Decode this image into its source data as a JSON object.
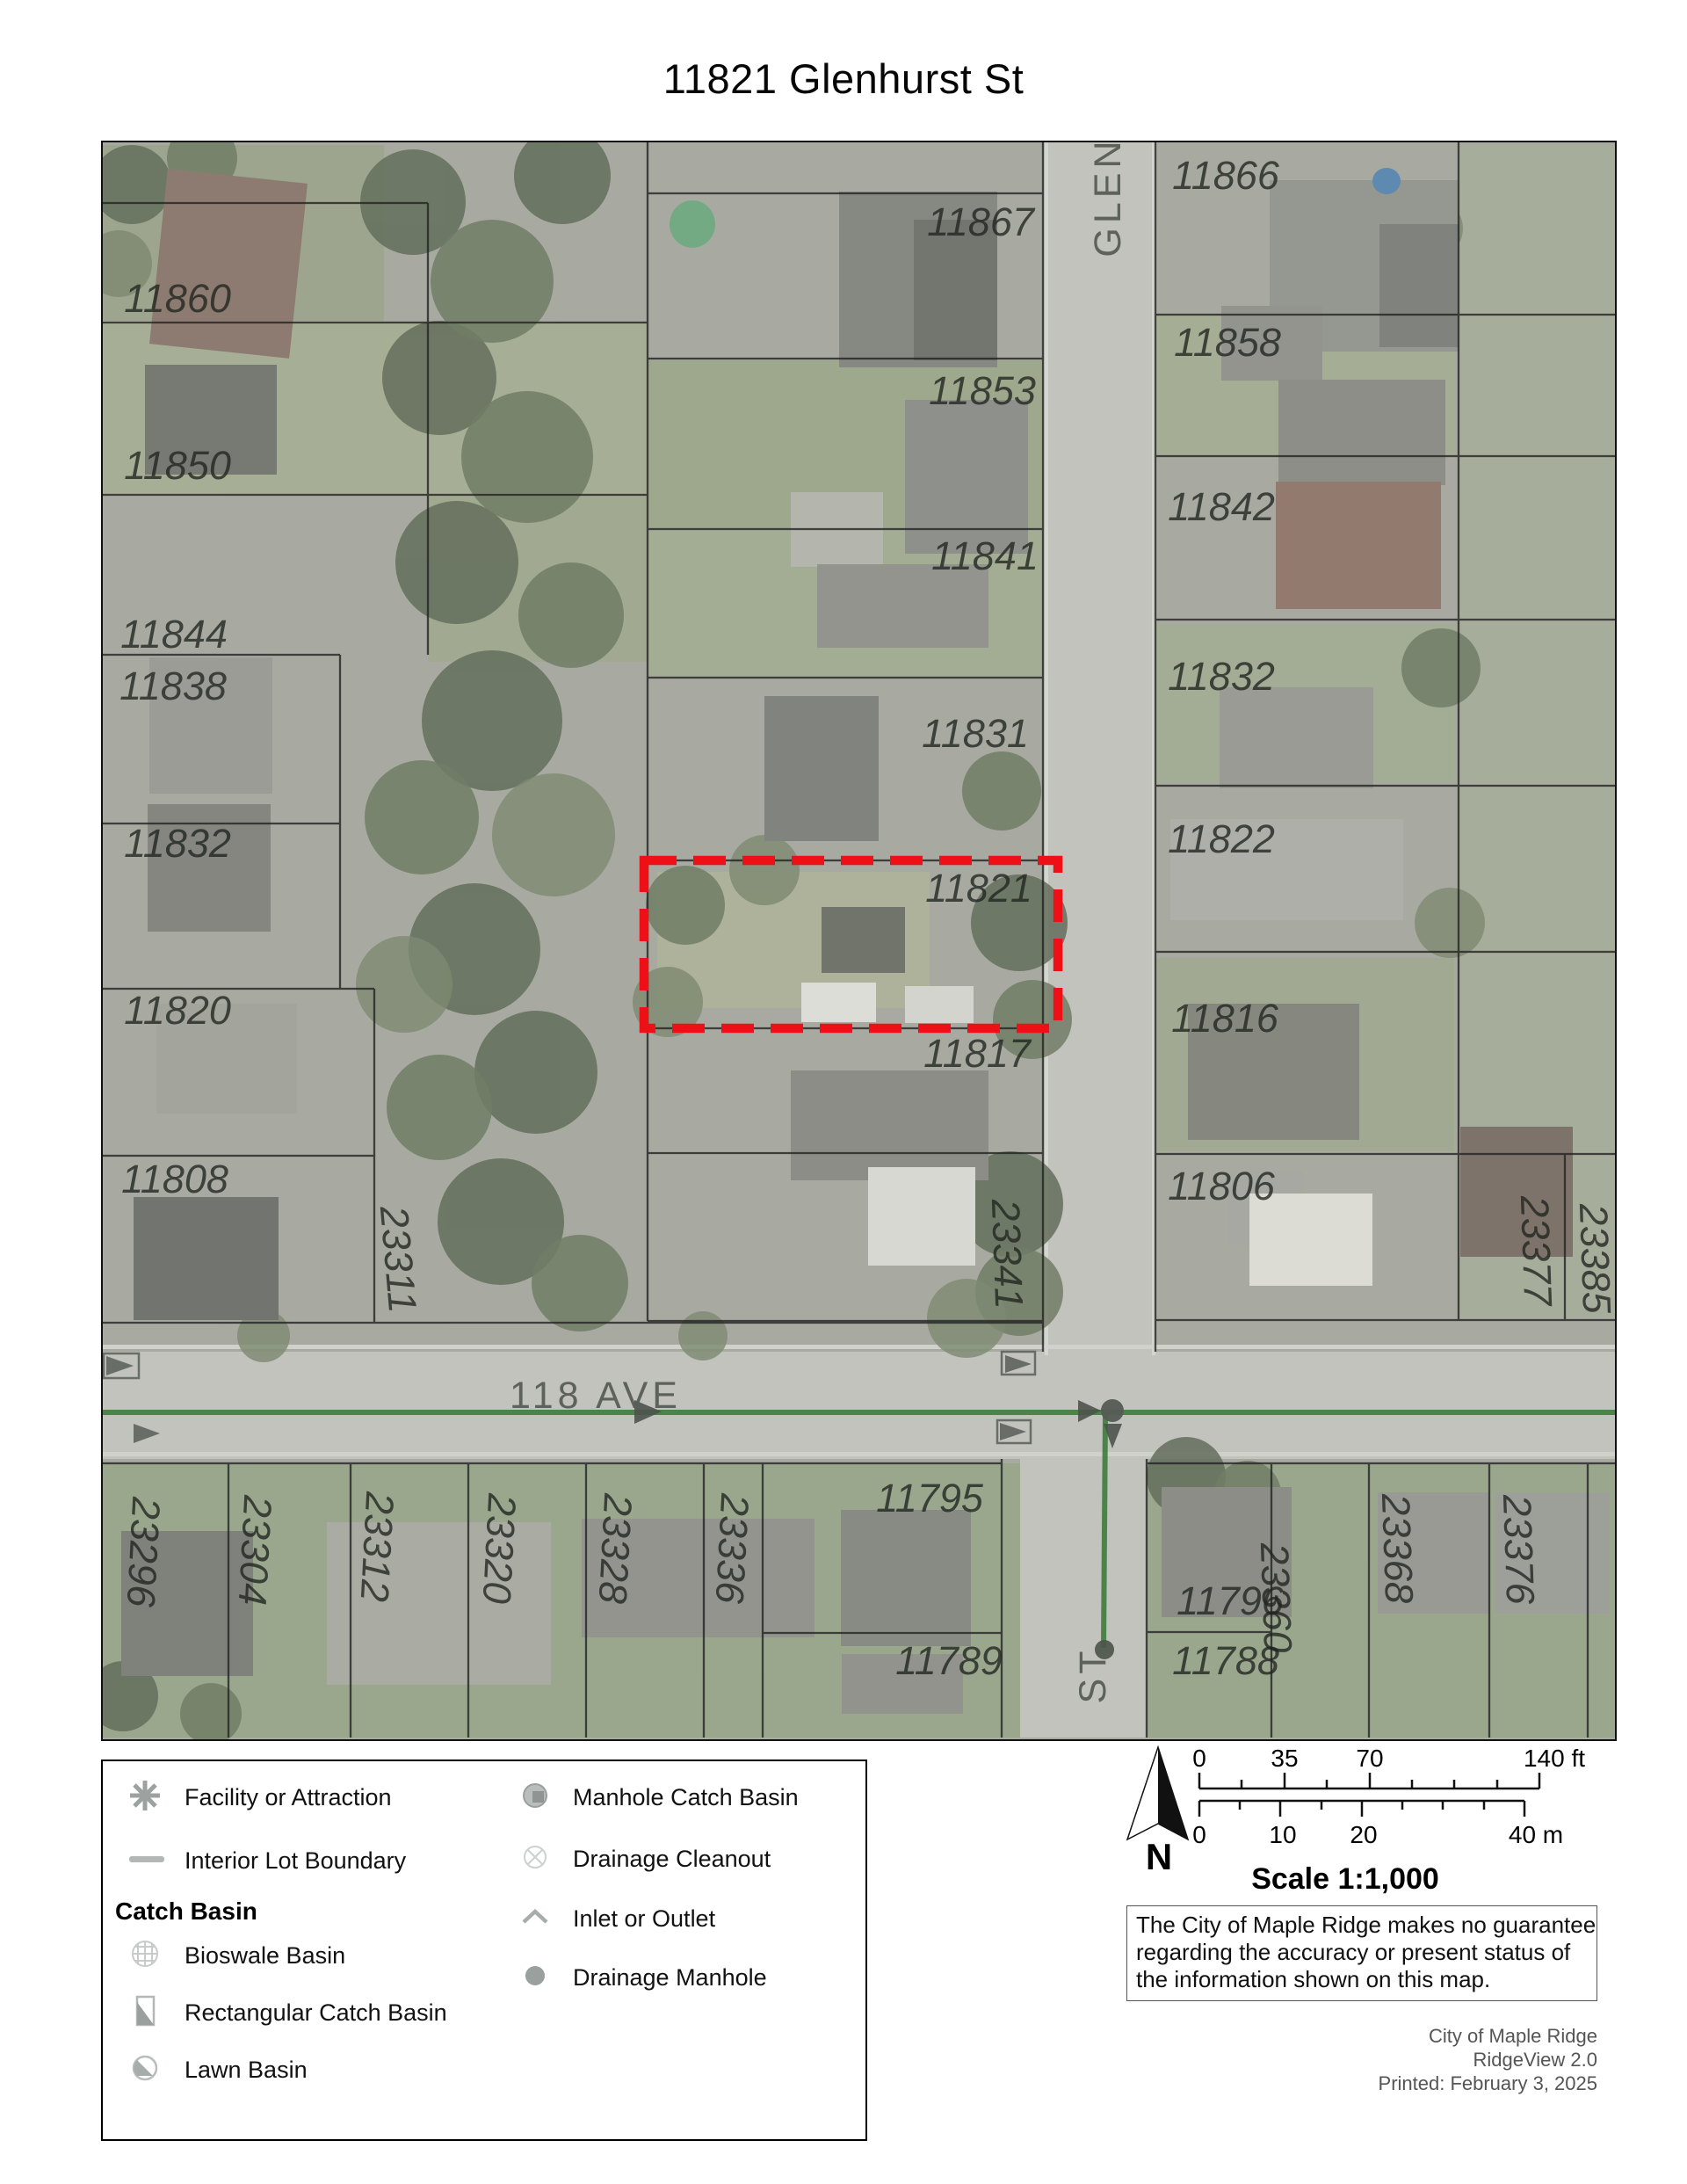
{
  "title": "11821 Glenhurst St",
  "map": {
    "subject_parcel": "11821",
    "parcel_labels": [
      "11860",
      "11850",
      "11844",
      "11838",
      "11832",
      "11820",
      "11808",
      "23311",
      "11867",
      "11853",
      "11841",
      "11831",
      "11821",
      "11817",
      "23341",
      "11866",
      "11858",
      "11842",
      "11832",
      "11822",
      "11816",
      "11806",
      "23377",
      "23385",
      "23296",
      "23304",
      "23312",
      "23320",
      "23328",
      "23336",
      "11795",
      "11789",
      "11796",
      "11788",
      "23360",
      "23368",
      "23376"
    ],
    "street_labels": {
      "glenhurst_upper": "GLEN",
      "avenue": "118 AVE",
      "glenhurst_lower": "ST"
    },
    "colors": {
      "highlight_red": "#ee1016",
      "drainage_green": "#3f7c3c"
    }
  },
  "legend": {
    "facility": "Facility or Attraction",
    "interior_lot": "Interior Lot Boundary",
    "catch_basin_header": "Catch Basin",
    "bioswale": "Bioswale Basin",
    "rectangular": "Rectangular Catch Basin",
    "lawn": "Lawn Basin",
    "manhole_catch_basin": "Manhole Catch Basin",
    "drainage_cleanout": "Drainage Cleanout",
    "inlet_outlet": "Inlet or Outlet",
    "drainage_manhole": "Drainage Manhole"
  },
  "scale_bar": {
    "ft": [
      "0",
      "35",
      "70",
      "140 ft"
    ],
    "m": [
      "0",
      "10",
      "20",
      "40 m"
    ],
    "scale_text": "Scale 1:1,000",
    "north": "N"
  },
  "disclaimer": {
    "line1": "The City of Maple Ridge makes no guarantee",
    "line2": "regarding the accuracy or present status of",
    "line3": "the information shown on this map."
  },
  "credits": {
    "line1": "City of Maple Ridge",
    "line2": "RidgeView 2.0",
    "line3": "Printed: February 3, 2025"
  }
}
